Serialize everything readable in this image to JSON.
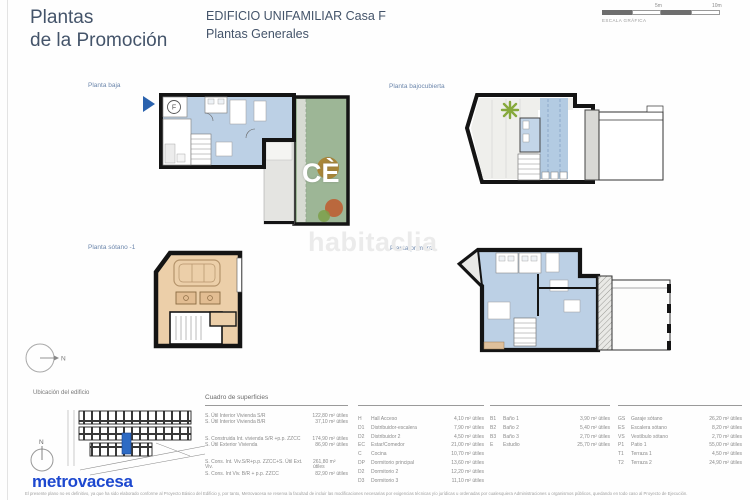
{
  "header": {
    "title_line1": "Plantas",
    "title_line2": "de la Promoción",
    "subtitle_line1": "EDIFICIO UNIFAMILIAR Casa F",
    "subtitle_line2": "Plantas Generales"
  },
  "scale": {
    "tick_mid": "5m",
    "tick_end": "10m",
    "caption": "ESCALA GRÁFICA"
  },
  "plans": {
    "baja": {
      "label": "Planta baja",
      "marker_letter": "F"
    },
    "bajocubierta": {
      "label": "Planta bajocubierta"
    },
    "sotano": {
      "label": "Planta sótano -1"
    },
    "primera": {
      "label": "Planta primera"
    }
  },
  "watermarks": {
    "center": "habitaclia",
    "garden": "CÈ"
  },
  "location": {
    "label": "Ubicación del edificio",
    "north": "N"
  },
  "logo_text": "metrovacesa",
  "disclaimer": "El presente plano no es definitivo, ya que ha sido elaborado conforme al Proyecto Básico del Edificio y, por tanto, Metrovacesa se reserva la facultad de incluir las modificaciones necesarias por exigencias técnicas y/o jurídicas u ordenadas por cualesquiera Administraciones u organismos públicos, quedando en todo caso al Proyecto de Ejecución.",
  "surfaces": {
    "title": "Cuadro de superficies",
    "summary": [
      {
        "label": "S. Útil Interior Vivienda S/R",
        "value": "122,80 m² útiles"
      },
      {
        "label": "S. Útil Interior Vivienda B/R",
        "value": "37,10 m² útiles"
      },
      {
        "label": "S. Construida Int. vivienda S/R +p.p. ZZCC",
        "value": "174,90 m² útiles"
      },
      {
        "label": "S. Útil Exterior Vivienda",
        "value": "86,90 m² útiles"
      },
      {
        "label": "S. Cons. Int. Viv.S/R+p.p. ZZCC+S. Útil Ext. Viv.",
        "value": "261,80 m² útiles"
      },
      {
        "label": "S. Cons. Int Viv. B/R + p.p. ZZCC",
        "value": "82,90 m² útiles"
      }
    ],
    "rooms_a": [
      {
        "code": "H",
        "name": "Hall Acceso",
        "value": "4,10 m² útiles"
      },
      {
        "code": "D1",
        "name": "Distribuidor-escalera",
        "value": "7,90 m² útiles"
      },
      {
        "code": "D2",
        "name": "Distribuidor 2",
        "value": "4,50 m² útiles"
      },
      {
        "code": "EC",
        "name": "Estar/Comedor",
        "value": "21,00 m² útiles"
      },
      {
        "code": "C",
        "name": "Cocina",
        "value": "10,70 m² útiles"
      },
      {
        "code": "DP",
        "name": "Dormitorio principal",
        "value": "13,60 m² útiles"
      },
      {
        "code": "D2",
        "name": "Dormitorio 2",
        "value": "12,20 m² útiles"
      },
      {
        "code": "D3",
        "name": "Dormitorio 3",
        "value": "11,10 m² útiles"
      }
    ],
    "rooms_b": [
      {
        "code": "B1",
        "name": "Baño 1",
        "value": "3,90 m² útiles"
      },
      {
        "code": "B2",
        "name": "Baño 2",
        "value": "5,40 m² útiles"
      },
      {
        "code": "B3",
        "name": "Baño 3",
        "value": "2,70 m² útiles"
      },
      {
        "code": "E",
        "name": "Estudio",
        "value": "25,70 m² útiles"
      }
    ],
    "rooms_c": [
      {
        "code": "GS",
        "name": "Garaje sótano",
        "value": "26,20 m² útiles"
      },
      {
        "code": "ES",
        "name": "Escalera sótano",
        "value": "8,20 m² útiles"
      },
      {
        "code": "VS",
        "name": "Vestíbulo sótano",
        "value": "2,70 m² útiles"
      },
      {
        "code": "P1",
        "name": "Patio 1",
        "value": "55,00 m² útiles"
      },
      {
        "code": "T1",
        "name": "Terraza 1",
        "value": "4,50 m² útiles"
      },
      {
        "code": "T2",
        "name": "Terraza 2",
        "value": "24,90 m² útiles"
      }
    ]
  },
  "colors": {
    "accent_blue": "#2a62ae",
    "room_fill": "#bcd0e5",
    "garden_green": "#9db696",
    "garage_tan": "#eccfa9",
    "logo_blue": "#1d48cf"
  }
}
